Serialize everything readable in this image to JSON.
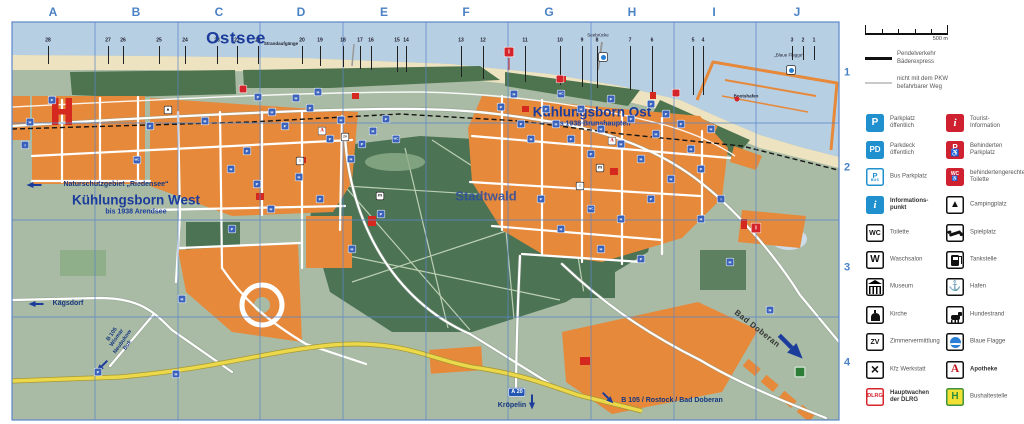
{
  "map": {
    "grid": {
      "columns": [
        {
          "label": "A",
          "x": 53
        },
        {
          "label": "B",
          "x": 136
        },
        {
          "label": "C",
          "x": 219
        },
        {
          "label": "D",
          "x": 301
        },
        {
          "label": "E",
          "x": 384
        },
        {
          "label": "F",
          "x": 466
        },
        {
          "label": "G",
          "x": 549
        },
        {
          "label": "H",
          "x": 632
        },
        {
          "label": "I",
          "x": 714
        },
        {
          "label": "J",
          "x": 797
        }
      ],
      "rows": [
        {
          "label": "1",
          "y": 73
        },
        {
          "label": "2",
          "y": 168
        },
        {
          "label": "3",
          "y": 268
        },
        {
          "label": "4",
          "y": 363
        }
      ]
    },
    "beach_access": {
      "label": "Strandaufgänge",
      "label_x": 281,
      "label_y": 44,
      "numbers": [
        {
          "n": "28",
          "x": 48
        },
        {
          "n": "27",
          "x": 108
        },
        {
          "n": "26",
          "x": 123
        },
        {
          "n": "25",
          "x": 159
        },
        {
          "n": "24",
          "x": 185
        },
        {
          "n": "23",
          "x": 217
        },
        {
          "n": "22",
          "x": 237
        },
        {
          "n": "21",
          "x": 258
        },
        {
          "n": "20",
          "x": 302
        },
        {
          "n": "19",
          "x": 320
        },
        {
          "n": "18",
          "x": 343
        },
        {
          "n": "17",
          "x": 360
        },
        {
          "n": "16",
          "x": 371
        },
        {
          "n": "15",
          "x": 397
        },
        {
          "n": "14",
          "x": 406
        },
        {
          "n": "13",
          "x": 461
        },
        {
          "n": "12",
          "x": 483
        },
        {
          "n": "11",
          "x": 525
        },
        {
          "n": "10",
          "x": 560
        },
        {
          "n": "9",
          "x": 582
        },
        {
          "n": "8",
          "x": 597
        },
        {
          "n": "7",
          "x": 630
        },
        {
          "n": "6",
          "x": 652
        },
        {
          "n": "5",
          "x": 693
        },
        {
          "n": "4",
          "x": 703
        },
        {
          "n": "3",
          "x": 792
        },
        {
          "n": "2",
          "x": 803
        },
        {
          "n": "1",
          "x": 814
        }
      ]
    },
    "labels": [
      {
        "id": "ostsee",
        "text": "Ostsee",
        "x": 236,
        "y": 38,
        "cls": "sea-name"
      },
      {
        "id": "seebruecke",
        "text": "Seebrücke",
        "x": 598,
        "y": 36,
        "cls": "tiny"
      },
      {
        "id": "blaue-flagge-note",
        "text": "„Blaue Flagge“",
        "x": 789,
        "y": 56,
        "cls": "tiny"
      },
      {
        "id": "bootshafen",
        "text": "Bootshafen",
        "x": 746,
        "y": 97,
        "cls": "tiny-bold"
      },
      {
        "id": "kuehlungsborn-ost",
        "text": "Kühlungsborn Ost",
        "sub": "bis 1938 Brunshaupten",
        "x": 592,
        "y": 117,
        "cls": "town"
      },
      {
        "id": "kuehlungsborn-west",
        "text": "Kühlungsborn West",
        "sub": "bis 1938 Arendsee",
        "x": 136,
        "y": 205,
        "cls": "town"
      },
      {
        "id": "naturschutzgebiet",
        "text": "Naturschutzgebiet „Riedensee“",
        "x": 116,
        "y": 185,
        "cls": "small-bold",
        "arrow": "left",
        "ax": 34,
        "ay": 185
      },
      {
        "id": "stadtwald",
        "text": "Stadtwald",
        "x": 486,
        "y": 196,
        "cls": "forest-name"
      },
      {
        "id": "kaegsdorf",
        "text": "Kägsdorf",
        "x": 68,
        "y": 304,
        "cls": "small-bold",
        "arrow": "left",
        "ax": 36,
        "ay": 304
      },
      {
        "id": "b105-west",
        "text": "B 105\nWismar\nNeubukow\nBuk",
        "x": 120,
        "y": 340,
        "cls": "rotB small-bold",
        "rot": -55,
        "arrow": "sw",
        "ax": 102,
        "ay": 366
      },
      {
        "id": "a20",
        "text": "A 20",
        "x": 517,
        "y": 392,
        "cls": "a20"
      },
      {
        "id": "kroepelin",
        "text": "Kröpelin",
        "x": 512,
        "y": 406,
        "cls": "small-bold",
        "arrow": "down",
        "ax": 532,
        "ay": 402
      },
      {
        "id": "b105-ost",
        "text": "B 105 / Rostock / Bad Doberan",
        "x": 672,
        "y": 401,
        "cls": "small-bold",
        "arrow": "se",
        "ax": 608,
        "ay": 398
      },
      {
        "id": "bad-doberan",
        "text": "Bad Doberan",
        "x": 757,
        "y": 329,
        "cls": "street",
        "rot": 38,
        "arrow": "se",
        "ax": 791,
        "ay": 347,
        "arrow_scale": 2.2
      }
    ],
    "icons": [
      {
        "t": "P",
        "x": 52,
        "y": 100
      },
      {
        "t": "H",
        "x": 30,
        "y": 122
      },
      {
        "t": "i",
        "x": 25,
        "y": 145
      },
      {
        "t": "W",
        "x": 137,
        "y": 160
      },
      {
        "t": "P",
        "x": 150,
        "y": 126
      },
      {
        "t": "H",
        "x": 205,
        "y": 121
      },
      {
        "t": "P",
        "x": 258,
        "y": 97
      },
      {
        "t": "H",
        "x": 272,
        "y": 112
      },
      {
        "t": "P",
        "x": 285,
        "y": 126
      },
      {
        "t": "H",
        "x": 296,
        "y": 98
      },
      {
        "t": "P",
        "x": 310,
        "y": 108
      },
      {
        "t": "H",
        "x": 318,
        "y": 92
      },
      {
        "t": "P",
        "x": 330,
        "y": 139
      },
      {
        "t": "H",
        "x": 341,
        "y": 120
      },
      {
        "t": "P",
        "x": 247,
        "y": 151
      },
      {
        "t": "H",
        "x": 231,
        "y": 169
      },
      {
        "t": "P",
        "x": 257,
        "y": 184
      },
      {
        "t": "H",
        "x": 299,
        "y": 177
      },
      {
        "t": "P",
        "x": 320,
        "y": 199
      },
      {
        "t": "H",
        "x": 351,
        "y": 159
      },
      {
        "t": "P",
        "x": 362,
        "y": 144
      },
      {
        "t": "H",
        "x": 373,
        "y": 131
      },
      {
        "t": "P",
        "x": 386,
        "y": 119
      },
      {
        "t": "W",
        "x": 396,
        "y": 139
      },
      {
        "t": "H",
        "x": 271,
        "y": 209
      },
      {
        "t": "P",
        "x": 232,
        "y": 229
      },
      {
        "t": "H",
        "x": 182,
        "y": 299
      },
      {
        "t": "H",
        "x": 352,
        "y": 249
      },
      {
        "t": "P",
        "x": 381,
        "y": 214
      },
      {
        "t": "P",
        "x": 98,
        "y": 372
      },
      {
        "t": "H",
        "x": 176,
        "y": 374
      },
      {
        "t": "P",
        "x": 501,
        "y": 107
      },
      {
        "t": "H",
        "x": 514,
        "y": 94
      },
      {
        "t": "P",
        "x": 521,
        "y": 124
      },
      {
        "t": "H",
        "x": 531,
        "y": 139
      },
      {
        "t": "P",
        "x": 546,
        "y": 109
      },
      {
        "t": "H",
        "x": 556,
        "y": 124
      },
      {
        "t": "W",
        "x": 561,
        "y": 94
      },
      {
        "t": "P",
        "x": 571,
        "y": 139
      },
      {
        "t": "H",
        "x": 581,
        "y": 109
      },
      {
        "t": "P",
        "x": 591,
        "y": 154
      },
      {
        "t": "H",
        "x": 601,
        "y": 129
      },
      {
        "t": "P",
        "x": 611,
        "y": 99
      },
      {
        "t": "H",
        "x": 621,
        "y": 144
      },
      {
        "t": "P",
        "x": 631,
        "y": 119
      },
      {
        "t": "H",
        "x": 641,
        "y": 159
      },
      {
        "t": "P",
        "x": 651,
        "y": 104
      },
      {
        "t": "H",
        "x": 656,
        "y": 134
      },
      {
        "t": "P",
        "x": 666,
        "y": 114
      },
      {
        "t": "H",
        "x": 671,
        "y": 179
      },
      {
        "t": "P",
        "x": 681,
        "y": 124
      },
      {
        "t": "H",
        "x": 691,
        "y": 149
      },
      {
        "t": "P",
        "x": 701,
        "y": 169
      },
      {
        "t": "H",
        "x": 711,
        "y": 129
      },
      {
        "t": "P",
        "x": 651,
        "y": 199
      },
      {
        "t": "H",
        "x": 621,
        "y": 219
      },
      {
        "t": "W",
        "x": 591,
        "y": 209
      },
      {
        "t": "H",
        "x": 561,
        "y": 229
      },
      {
        "t": "P",
        "x": 541,
        "y": 199
      },
      {
        "t": "H",
        "x": 601,
        "y": 249
      },
      {
        "t": "P",
        "x": 641,
        "y": 259
      },
      {
        "t": "H",
        "x": 701,
        "y": 219
      },
      {
        "t": "i",
        "x": 721,
        "y": 199
      },
      {
        "t": "H",
        "x": 730,
        "y": 262
      },
      {
        "t": "H",
        "x": 770,
        "y": 310
      },
      {
        "t": "R",
        "x": 509,
        "y": 52
      },
      {
        "t": "O",
        "x": 737,
        "y": 99
      },
      {
        "t": "R",
        "x": 756,
        "y": 228
      },
      {
        "t": "D",
        "x": 243,
        "y": 89
      },
      {
        "t": "D",
        "x": 560,
        "y": 79
      },
      {
        "t": "D",
        "x": 676,
        "y": 93
      },
      {
        "t": "A",
        "x": 322,
        "y": 131
      },
      {
        "t": "A",
        "x": 612,
        "y": 141
      },
      {
        "t": "M",
        "x": 600,
        "y": 168
      },
      {
        "t": "M",
        "x": 380,
        "y": 196
      },
      {
        "t": "K",
        "x": 300,
        "y": 161
      },
      {
        "t": "K",
        "x": 580,
        "y": 186
      },
      {
        "t": "Z",
        "x": 345,
        "y": 137
      },
      {
        "t": "C",
        "x": 168,
        "y": 110
      },
      {
        "t": "F",
        "x": 603,
        "y": 57
      },
      {
        "t": "F",
        "x": 791,
        "y": 70
      },
      {
        "t": "G",
        "x": 800,
        "y": 372
      }
    ]
  },
  "legend": {
    "scale": {
      "label": "500 m"
    },
    "route_lines": [
      {
        "name": "baederexpress",
        "label": "Pendelverkehr\nBäderexpress"
      },
      {
        "name": "no-car-path",
        "label": "nicht mit dem PKW\nbefahrbarer Weg"
      }
    ],
    "columns": {
      "left": [
        {
          "icon": "p",
          "label": "Parkplatz\nöffentlich"
        },
        {
          "icon": "pd",
          "label": "Parkdeck\nöffentlich"
        },
        {
          "icon": "pbus",
          "label": "Bus Parkplatz"
        },
        {
          "icon": "info",
          "label": "Informations-\npunkt",
          "bold": true
        },
        {
          "icon": "wc",
          "label": "Toilette"
        },
        {
          "icon": "w",
          "label": "Waschsalon"
        },
        {
          "icon": "museum",
          "label": "Museum"
        },
        {
          "icon": "church",
          "label": "Kirche"
        },
        {
          "icon": "zv",
          "label": "Zimmervermittlung"
        },
        {
          "icon": "kfz",
          "label": "Kfz Werkstatt"
        },
        {
          "icon": "dlrg",
          "label": "Hauptwachen\nder DLRG",
          "bold": true
        }
      ],
      "right": [
        {
          "icon": "tourist",
          "label": "Tourist-\nInformation"
        },
        {
          "icon": "pdis",
          "label": "Behinderten\nParkplatz"
        },
        {
          "icon": "wcdis",
          "label": "behindertengerechte\nToilette"
        },
        {
          "icon": "camp",
          "label": "Campingplatz"
        },
        {
          "icon": "play",
          "label": "Spielplatz"
        },
        {
          "icon": "fuel",
          "label": "Tankstelle"
        },
        {
          "icon": "hafen",
          "label": "Hafen"
        },
        {
          "icon": "dog",
          "label": "Hundestrand"
        },
        {
          "icon": "flag",
          "label": "Blaue Flagge"
        },
        {
          "icon": "apo",
          "label": "Apotheke",
          "bold": true
        },
        {
          "icon": "bus",
          "label": "Bushaltestelle"
        }
      ]
    }
  },
  "colors": {
    "sea": "#b7cfe3",
    "beach": "#eee3c0",
    "land": "#a9bba4",
    "dune": "#4e744f",
    "forest": "#4d7355",
    "town": "#e6893b",
    "building": "#d5281e",
    "road_yellow": "#ecd94b",
    "grid": "#5b86c8",
    "label": "#1c3c9c",
    "sign_blue": "#2090cf",
    "sign_red": "#cf2130",
    "bus_yellow": "#f2e135",
    "bus_green": "#3f9340"
  }
}
